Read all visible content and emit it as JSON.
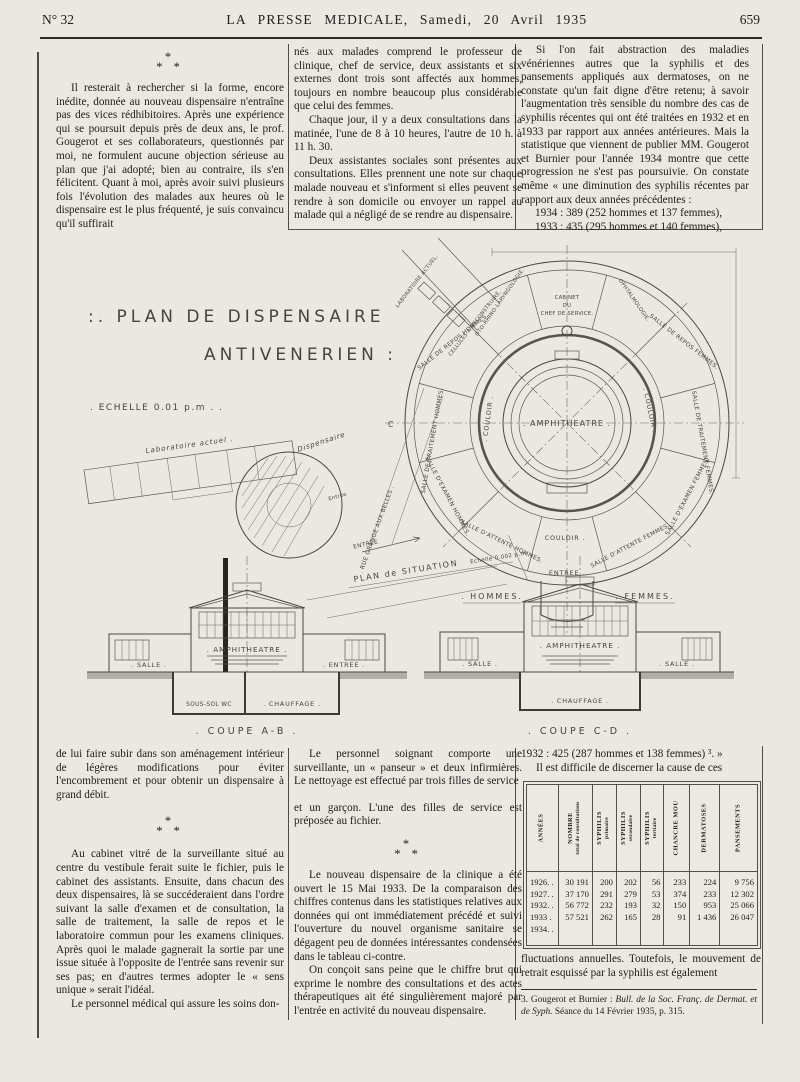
{
  "page": {
    "issue": "N° 32",
    "masthead": "LA PRESSE MEDICALE, Samedi, 20 Avril 1935",
    "page_number": "659"
  },
  "asterism": {
    "l1": "*",
    "l2": "* *"
  },
  "top": {
    "col1": {
      "p1": "Il resterait à rechercher si la forme, encore inédite, donnée au nouveau dispensaire n'entraîne pas des vices rédhibitoires. Après une expérience qui se poursuit depuis près de deux ans, le prof. Gougerot et ses collaborateurs, questionnés par moi, ne formulent aucune objection sérieuse au plan que j'ai adopté; bien au contraire, ils s'en félicitent. Quant à moi, après avoir suivi plusieurs fois l'évolution des malades aux heures où le dispensaire est le plus fréquenté, je suis convaincu qu'il suffirait"
    },
    "col2": {
      "p1": "nés aux malades comprend le professeur de clinique, chef de service, deux assistants et six externes dont trois sont affectés aux hommes, toujours en nombre beaucoup plus considérable que celui des femmes.",
      "p2": "Chaque jour, il y a deux consultations dans la matinée, l'une de 8 à 10 heures, l'autre de 10 h. à 11 h. 30.",
      "p3": "Deux assistantes sociales sont présentes aux consultations. Elles prennent une note sur chaque malade nouveau et s'informent si elles peuvent se rendre à son domicile ou envoyer un rappel au malade qui a négligé de se rendre au dispensaire."
    },
    "col3": {
      "p1": "Si l'on fait abstraction des maladies vénériennes autres que la syphilis et des pansements appliqués aux dermatoses, on ne constate qu'un fait digne d'être retenu; à savoir l'augmentation très sensible du nombre des cas de syphilis récentes qui ont été traitées en 1932 et en 1933 par rapport aux années antérieures. Mais la statistique que viennent de publier MM. Gougerot et Burnier pour l'année 1934 montre que cette progression ne s'est pas poursuivie. On constate même « une diminution des syphilis récentes par rapport aux deux années précédentes :",
      "stat1": "1934 : 389 (252 hommes et 137 femmes),",
      "stat2": "1933 : 435 (295 hommes et 140 femmes),"
    }
  },
  "figure": {
    "title1": ":. PLAN  DE  DISPENSAIRE",
    "title2": "ANTIVENERIEN :",
    "echelle": ". ECHELLE   0.01 p.m . .",
    "amphitheatre": ". AMPHITHEATRE .",
    "couloir_left": ". COULOIR .",
    "couloir_right": ". COULOIR .",
    "couloir_bottom": "COULOIR .",
    "cabinet1": "CABINET",
    "cabinet2": "DU",
    "cabinet3": "CHEF DE SERVICE.",
    "ophtalmologie": "OPHTALMOLOGIE.",
    "orl": "OTO-RHINO-LARYNGOLOGIE.",
    "repos_f": "SALLE DE REPOS FEMMES.",
    "trait_f": "SALLE DE TRAITEMENT FEMMES.",
    "exam_f": "SALLE D'EXAMEN FEMMES.",
    "att_f": "SALLE D'ATTENTE FEMMES.",
    "entree_plan": "ENTREE .",
    "att_h": "SALLE D'ATTENTE HOMMES.",
    "exam_h": "SALLE D'EXAMEN HOMMES.",
    "trait_h": "SALLE DE TRAITEMENT HOMMES.",
    "repos_h": "SALLE DE REPOS HOMMES.",
    "laboratoire_actuel": "LABORATOIRE ACTUEL.",
    "cellules": "CELLULES A RECONSTRUIRE.",
    "rue": ". RUE GRANGE AUX BELLES .",
    "entree_rue": "ENTREE",
    "hommes": ". HOMMES.",
    "femmes": ". FEMMES.",
    "mark_c": "C",
    "mark_d": "D",
    "sit_labo": "Laboratoire actuel .",
    "sit_dispensaire": "Dispensaire",
    "sit_entree": "Entrée",
    "sit_caption": "PLAN de SITUATION",
    "sit_echelle": "Echelle 0.002 p.m.",
    "ab_salle": ". SALLE .",
    "ab_amphi": ". AMPHITHEATRE .",
    "ab_entree": ". ENTREE .",
    "ab_soussol": "SOUS-SOL  WC",
    "ab_chauffage": ". CHAUFFAGE .",
    "ab_caption": ". COUPE  A-B .",
    "cd_salle1": ". SALLE .",
    "cd_amphi": ". AMPHITHEATRE .",
    "cd_salle2": ". SALLE .",
    "cd_chauffage": ". CHAUFFAGE .",
    "cd_caption": ". COUPE  C-D ."
  },
  "bottom": {
    "col1": {
      "p1": "de lui faire subir dans son aménagement intérieur de légères modifications pour éviter l'encombrement et pour obtenir un dispensaire à grand débit.",
      "p2": "Au cabinet vitré de la surveillante situé au centre du vestibule ferait suite le fichier, puis le cabinet des assistants. Ensuite, dans chacun des deux dispensaires, là se succéderaient dans l'ordre suivant la salle d'examen et de consultation, la salle de traitement, la salle de repos et le laboratoire commun pour les examens cliniques. Après quoi le malade gagnerait la sortie par une issue située à l'opposite de l'entrée sans revenir sur ses pas; en d'autres termes adopter le « sens unique » serait l'idéal.",
      "p3": "Le personnel médical qui assure les soins don-"
    },
    "col2": {
      "p1": "Le personnel soignant comporte une surveillante, un « panseur » et deux infirmières. Le nettoyage est effectué par trois filles de service",
      "p2": "et un garçon. L'une des filles de service est préposée au fichier.",
      "p3": "Le nouveau dispensaire de la clinique a été ouvert le 15 Mai 1933. De la comparaison des chiffres contenus dans les statistiques relatives aux données qui ont immédiatement précédé et suivi l'ouverture du nouvel organisme sanitaire se dégagent peu de données intéressantes condensées dans le tableau ci-contre.",
      "p4": "On conçoit sans peine que le chiffre brut qui exprime le nombre des consultations et des actes thérapeutiques ait été singulièrement majoré par l'entrée en activité du nouveau dispensaire."
    },
    "col3": {
      "line1": "1932 : 425 (287 hommes et 138 femmes) ³. »",
      "line2": "Il est difficile de discerner la cause de ces",
      "table": {
        "headers": [
          {
            "main": "ANNÉES",
            "sub": ""
          },
          {
            "main": "NOMBRE",
            "sub": "total de consultations"
          },
          {
            "main": "SYPHILIS",
            "sub": "primaire"
          },
          {
            "main": "SYPHILIS",
            "sub": "secondaire"
          },
          {
            "main": "SYPHILIS",
            "sub": "tertiaire"
          },
          {
            "main": "CHANCRE MOU",
            "sub": ""
          },
          {
            "main": "DERMATOSES",
            "sub": ""
          },
          {
            "main": "PANSEMENTS",
            "sub": ""
          }
        ],
        "rows": [
          {
            "year": "1926. .",
            "v": [
              "30 191",
              "200",
              "202",
              "56",
              "233",
              "224",
              "9 756"
            ]
          },
          {
            "year": "1927. .",
            "v": [
              "37 170",
              "291",
              "279",
              "53",
              "374",
              "233",
              "12 302"
            ]
          },
          {
            "year": "1932. .",
            "v": [
              "56 772",
              "232",
              "193",
              "32",
              "150",
              "953",
              "25 066"
            ]
          },
          {
            "year": "1933 .",
            "v": [
              "57 521",
              "262",
              "165",
              "28",
              "91",
              "1 436",
              "26 047"
            ]
          },
          {
            "year": "1934. .",
            "v": [
              "",
              "",
              "",
              "",
              "",
              "",
              ""
            ]
          }
        ]
      },
      "after_table": "fluctuations annuelles. Toutefois, le mouvement de retrait esquissé par la syphilis est également",
      "footnote_prefix": "3. Gougerot et Burnier : ",
      "footnote_italic": "Bull. de la Soc. Franç. de Dermat. et de Syph.",
      "footnote_suffix": " Séance du 14 Février 1935, p. 315."
    }
  }
}
